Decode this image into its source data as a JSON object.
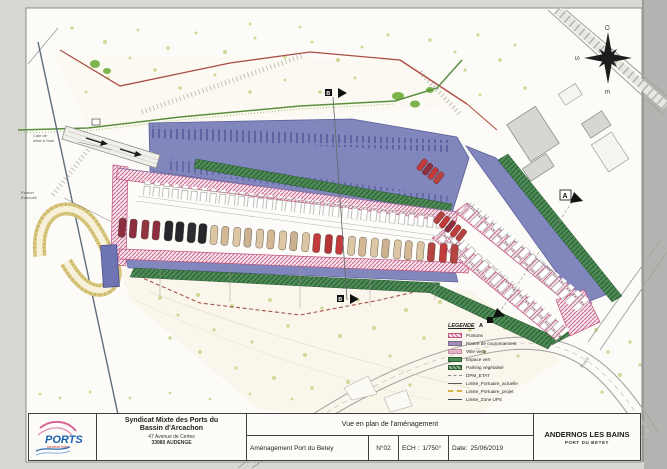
{
  "title_block": {
    "logo_text": "PORTS",
    "logo_subtext": "syndicat mixte",
    "org_line1": "Syndicat Mixte des Ports du",
    "org_line2": "Bassin d'Arcachon",
    "org_line3": "47 Avenue de Certes",
    "org_line4": "33980 AUDENGE",
    "drawing_title": "Vue en plan de l'aménagement",
    "project_name": "Aménagement Port du Betey",
    "sheet_number": "N°02",
    "scale_label": "ECH :",
    "scale_value": "1/750°",
    "date_label": "Date:",
    "date_value": "25/06/2019",
    "client_line1": "ANDERNOS LES BAINS",
    "client_line2": "PORT DU BETEY"
  },
  "legend": {
    "title": "LEGENDE",
    "items": [
      {
        "label": "Pontons"
      },
      {
        "label": "Poutre de couronnement"
      },
      {
        "label": "Voie verte"
      },
      {
        "label": "Espace vert"
      },
      {
        "label": "Parking végétalisé"
      },
      {
        "label": "DPM_ETAT"
      },
      {
        "label": "Limite_Portuaire_actuelle"
      },
      {
        "label": "Limite_Portuaire_projet"
      },
      {
        "label": "Limite_Zone UPS"
      }
    ]
  },
  "compass": {
    "top": "O",
    "left": "S",
    "bottom": "E"
  },
  "plan": {
    "section_a": "A",
    "section_b": "B",
    "street_label": "Bvard",
    "annotation1_line1": "Cale de",
    "annotation1_line2": "mise à l'eau",
    "annotation2_line1": "Ponton",
    "annotation2_line2": "d'accueil"
  },
  "colors": {
    "parking_blue": "#8186bd",
    "espace_vert_green": "#4c8b55",
    "pontoon_pink": "#cb6d92",
    "boat_red": "#c23b3b",
    "logo_blue": "#1b5fae"
  }
}
